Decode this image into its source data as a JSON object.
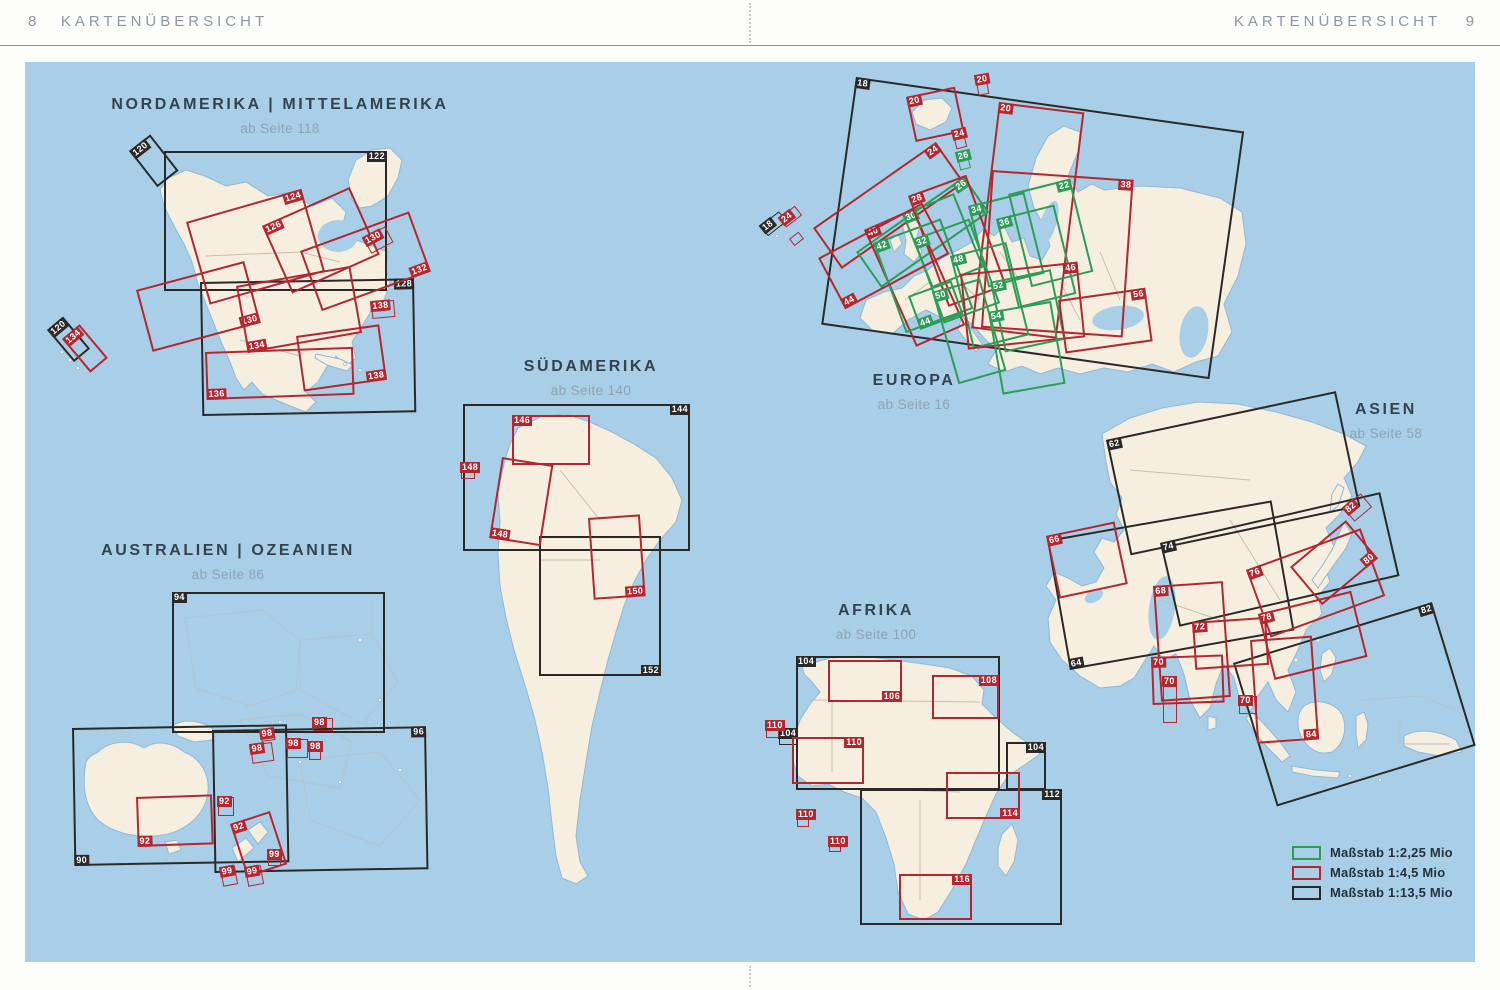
{
  "header": {
    "left_page": "8",
    "left_title": "KARTENÜBERSICHT",
    "right_title": "KARTENÜBERSICHT",
    "right_page": "9"
  },
  "colors": {
    "ocean": "#a9cfe8",
    "land": "#f6efdf",
    "scale_green": "#2d9c57",
    "scale_red": "#b5262f",
    "scale_black": "#2a2927"
  },
  "regions": [
    {
      "id": "nordamerika",
      "title": "NORDAMERIKA | MITTELAMERIKA",
      "subtitle": "ab Seite 118",
      "cx": 280,
      "y": 96
    },
    {
      "id": "suedamerika",
      "title": "SÜDAMERIKA",
      "subtitle": "ab Seite 140",
      "cx": 591,
      "y": 358
    },
    {
      "id": "australien",
      "title": "AUSTRALIEN | OZEANIEN",
      "subtitle": "ab Seite 86",
      "cx": 228,
      "y": 542
    },
    {
      "id": "europa",
      "title": "EUROPA",
      "subtitle": "ab Seite 16",
      "cx": 914,
      "y": 372
    },
    {
      "id": "asien",
      "title": "ASIEN",
      "subtitle": "ab Seite 58",
      "cx": 1386,
      "y": 401
    },
    {
      "id": "afrika",
      "title": "AFRIKA",
      "subtitle": "ab Seite 100",
      "cx": 876,
      "y": 602
    }
  ],
  "legend": {
    "items": [
      {
        "color": "green",
        "label": "Maßstab 1:2,25 Mio"
      },
      {
        "color": "red",
        "label": "Maßstab 1:4,5 Mio"
      },
      {
        "color": "black",
        "label": "Maßstab 1:13,5 Mio"
      }
    ]
  },
  "map_rects": [
    {
      "region": "nordamerika",
      "label": "122",
      "color": "black",
      "x": 164,
      "y": 151,
      "w": 223,
      "h": 140,
      "rot": 0,
      "corner": "tr"
    },
    {
      "region": "nordamerika",
      "label": "128",
      "color": "black",
      "x": 200,
      "y": 282,
      "w": 214,
      "h": 134,
      "rot": -1,
      "corner": "tr"
    },
    {
      "region": "nordamerika",
      "label": "120",
      "color": "black",
      "x": 129,
      "y": 151,
      "w": 27,
      "h": 46,
      "rot": -38,
      "corner": "tl"
    },
    {
      "region": "nordamerika",
      "label": "120",
      "color": "black",
      "x": 47,
      "y": 330,
      "w": 21,
      "h": 42,
      "rot": -40,
      "corner": "tl"
    },
    {
      "region": "nordamerika",
      "label": "134",
      "color": "red",
      "x": 62,
      "y": 339,
      "w": 23,
      "h": 44,
      "rot": -40,
      "corner": "tl"
    },
    {
      "region": "nordamerika",
      "label": "124",
      "color": "red",
      "x": 186,
      "y": 222,
      "w": 120,
      "h": 86,
      "rot": -16,
      "corner": "tr"
    },
    {
      "region": "nordamerika",
      "label": "126",
      "color": "red",
      "x": 262,
      "y": 226,
      "w": 96,
      "h": 74,
      "rot": -24,
      "corner": "tl"
    },
    {
      "region": "nordamerika",
      "label": "130",
      "color": "red",
      "x": 363,
      "y": 238,
      "w": 25,
      "h": 18,
      "rot": -28,
      "corner": "tl"
    },
    {
      "region": "nordamerika",
      "label": "130",
      "color": "red",
      "x": 136,
      "y": 290,
      "w": 112,
      "h": 64,
      "rot": -15,
      "corner": "br"
    },
    {
      "region": "nordamerika",
      "label": "132",
      "color": "red",
      "x": 300,
      "y": 251,
      "w": 116,
      "h": 64,
      "rot": -20,
      "corner": "br"
    },
    {
      "region": "nordamerika",
      "label": "134",
      "color": "red",
      "x": 236,
      "y": 286,
      "w": 116,
      "h": 68,
      "rot": -10,
      "corner": "bl"
    },
    {
      "region": "nordamerika",
      "label": "136",
      "color": "red",
      "x": 205,
      "y": 352,
      "w": 148,
      "h": 48,
      "rot": -2,
      "corner": "bl"
    },
    {
      "region": "nordamerika",
      "label": "138",
      "color": "red",
      "x": 371,
      "y": 302,
      "w": 23,
      "h": 17,
      "rot": -5,
      "corner": "tl"
    },
    {
      "region": "nordamerika",
      "label": "138",
      "color": "red",
      "x": 296,
      "y": 336,
      "w": 84,
      "h": 56,
      "rot": -8,
      "corner": "br"
    },
    {
      "region": "suedamerika",
      "label": "144",
      "color": "black",
      "x": 463,
      "y": 404,
      "w": 227,
      "h": 147,
      "rot": 0,
      "corner": "tr"
    },
    {
      "region": "suedamerika",
      "label": "152",
      "color": "black",
      "x": 539,
      "y": 536,
      "w": 122,
      "h": 140,
      "rot": 0,
      "corner": "br"
    },
    {
      "region": "suedamerika",
      "label": "146",
      "color": "red",
      "x": 512,
      "y": 415,
      "w": 78,
      "h": 50,
      "rot": 0,
      "corner": "tl"
    },
    {
      "region": "suedamerika",
      "label": "148",
      "color": "red",
      "x": 461,
      "y": 463,
      "w": 14,
      "h": 16,
      "rot": 0,
      "corner": "tl"
    },
    {
      "region": "suedamerika",
      "label": "148",
      "color": "red",
      "x": 502,
      "y": 457,
      "w": 52,
      "h": 82,
      "rot": 9,
      "corner": "bl"
    },
    {
      "region": "suedamerika",
      "label": "150",
      "color": "red",
      "x": 588,
      "y": 518,
      "w": 52,
      "h": 82,
      "rot": -4,
      "corner": "br"
    },
    {
      "region": "australien",
      "label": "94",
      "color": "black",
      "x": 172,
      "y": 592,
      "w": 213,
      "h": 141,
      "rot": 0,
      "corner": "tl"
    },
    {
      "region": "australien",
      "label": "90",
      "color": "black",
      "x": 72,
      "y": 728,
      "w": 215,
      "h": 138,
      "rot": -1,
      "corner": "bl"
    },
    {
      "region": "australien",
      "label": "96",
      "color": "black",
      "x": 212,
      "y": 730,
      "w": 214,
      "h": 143,
      "rot": -1,
      "corner": "tr"
    },
    {
      "region": "australien",
      "label": "92",
      "color": "red",
      "x": 136,
      "y": 797,
      "w": 76,
      "h": 50,
      "rot": -2,
      "corner": "bl"
    },
    {
      "region": "australien",
      "label": "92",
      "color": "red",
      "x": 218,
      "y": 797,
      "w": 16,
      "h": 19,
      "rot": 0,
      "corner": "tl"
    },
    {
      "region": "australien",
      "label": "92",
      "color": "red",
      "x": 230,
      "y": 824,
      "w": 42,
      "h": 56,
      "rot": -18,
      "corner": "tl"
    },
    {
      "region": "australien",
      "label": "98",
      "color": "red",
      "x": 250,
      "y": 745,
      "w": 22,
      "h": 19,
      "rot": -8,
      "corner": "tl"
    },
    {
      "region": "australien",
      "label": "98",
      "color": "red",
      "x": 260,
      "y": 730,
      "w": 14,
      "h": 12,
      "rot": -8,
      "corner": "tl"
    },
    {
      "region": "australien",
      "label": "98",
      "color": "red",
      "x": 287,
      "y": 739,
      "w": 21,
      "h": 19,
      "rot": 0,
      "corner": "tl"
    },
    {
      "region": "australien",
      "label": "98",
      "color": "red",
      "x": 309,
      "y": 742,
      "w": 12,
      "h": 18,
      "rot": 0,
      "corner": "tl"
    },
    {
      "region": "australien",
      "label": "98",
      "color": "red",
      "x": 313,
      "y": 718,
      "w": 20,
      "h": 13,
      "rot": 0,
      "corner": "tl"
    },
    {
      "region": "australien",
      "label": "99",
      "color": "red",
      "x": 220,
      "y": 868,
      "w": 15,
      "h": 19,
      "rot": -10,
      "corner": "tl"
    },
    {
      "region": "australien",
      "label": "99",
      "color": "red",
      "x": 245,
      "y": 868,
      "w": 16,
      "h": 19,
      "rot": -10,
      "corner": "tl"
    },
    {
      "region": "australien",
      "label": "99",
      "color": "red",
      "x": 268,
      "y": 850,
      "w": 13,
      "h": 16,
      "rot": 0,
      "corner": "tl"
    },
    {
      "region": "europa",
      "label": "18",
      "color": "black",
      "x": 856,
      "y": 77,
      "w": 392,
      "h": 250,
      "rot": 8,
      "corner": "tl"
    },
    {
      "region": "europa",
      "label": "18",
      "color": "black",
      "x": 760,
      "y": 226,
      "w": 24,
      "h": 13,
      "rot": -38,
      "corner": "tl"
    },
    {
      "region": "europa",
      "label": "24",
      "color": "red",
      "x": 779,
      "y": 218,
      "w": 20,
      "h": 12,
      "rot": -38,
      "corner": "tl"
    },
    {
      "region": "europa",
      "label": "",
      "color": "red",
      "x": 789,
      "y": 239,
      "w": 12,
      "h": 9,
      "rot": -38,
      "corner": "tl"
    },
    {
      "region": "europa",
      "label": "20",
      "color": "red",
      "x": 906,
      "y": 97,
      "w": 50,
      "h": 46,
      "rot": -12,
      "corner": "tl"
    },
    {
      "region": "europa",
      "label": "20",
      "color": "red",
      "x": 975,
      "y": 76,
      "w": 11,
      "h": 20,
      "rot": -10,
      "corner": "tl"
    },
    {
      "region": "europa",
      "label": "20",
      "color": "red",
      "x": 999,
      "y": 102,
      "w": 86,
      "h": 228,
      "rot": 7,
      "corner": "tl"
    },
    {
      "region": "europa",
      "label": "24",
      "color": "red",
      "x": 952,
      "y": 131,
      "w": 11,
      "h": 19,
      "rot": -14,
      "corner": "tl"
    },
    {
      "region": "europa",
      "label": "24",
      "color": "red",
      "x": 813,
      "y": 228,
      "w": 150,
      "h": 50,
      "rot": -35,
      "corner": "tr"
    },
    {
      "region": "europa",
      "label": "26",
      "color": "green",
      "x": 956,
      "y": 153,
      "w": 11,
      "h": 18,
      "rot": -14,
      "corner": "tl"
    },
    {
      "region": "europa",
      "label": "26",
      "color": "green",
      "x": 856,
      "y": 252,
      "w": 132,
      "h": 44,
      "rot": -35,
      "corner": "tr"
    },
    {
      "region": "europa",
      "label": "28",
      "color": "red",
      "x": 908,
      "y": 196,
      "w": 62,
      "h": 118,
      "rot": -20,
      "corner": "tl"
    },
    {
      "region": "europa",
      "label": "30",
      "color": "green",
      "x": 902,
      "y": 214,
      "w": 56,
      "h": 80,
      "rot": -22,
      "corner": "tl"
    },
    {
      "region": "europa",
      "label": "22",
      "color": "green",
      "x": 1008,
      "y": 194,
      "w": 64,
      "h": 96,
      "rot": -14,
      "corner": "tr"
    },
    {
      "region": "europa",
      "label": "34",
      "color": "green",
      "x": 968,
      "y": 206,
      "w": 58,
      "h": 84,
      "rot": -14,
      "corner": "tl"
    },
    {
      "region": "europa",
      "label": "36",
      "color": "green",
      "x": 996,
      "y": 219,
      "w": 60,
      "h": 92,
      "rot": -14,
      "corner": "tl"
    },
    {
      "region": "europa",
      "label": "38",
      "color": "red",
      "x": 992,
      "y": 170,
      "w": 142,
      "h": 158,
      "rot": 4,
      "corner": "tr"
    },
    {
      "region": "europa",
      "label": "40",
      "color": "red",
      "x": 864,
      "y": 230,
      "w": 54,
      "h": 128,
      "rot": -24,
      "corner": "tl"
    },
    {
      "region": "europa",
      "label": "42",
      "color": "green",
      "x": 873,
      "y": 243,
      "w": 72,
      "h": 96,
      "rot": -20,
      "corner": "tl"
    },
    {
      "region": "europa",
      "label": "32",
      "color": "green",
      "x": 913,
      "y": 239,
      "w": 60,
      "h": 90,
      "rot": -20,
      "corner": "tl"
    },
    {
      "region": "europa",
      "label": "48",
      "color": "green",
      "x": 950,
      "y": 256,
      "w": 58,
      "h": 96,
      "rot": -14,
      "corner": "tl"
    },
    {
      "region": "europa",
      "label": "44",
      "color": "red",
      "x": 818,
      "y": 258,
      "w": 118,
      "h": 58,
      "rot": -28,
      "corner": "bl"
    },
    {
      "region": "europa",
      "label": "44",
      "color": "green",
      "x": 908,
      "y": 296,
      "w": 46,
      "h": 36,
      "rot": -20,
      "corner": "bl"
    },
    {
      "region": "europa",
      "label": "50",
      "color": "green",
      "x": 932,
      "y": 292,
      "w": 50,
      "h": 96,
      "rot": -16,
      "corner": "tl"
    },
    {
      "region": "europa",
      "label": "46",
      "color": "red",
      "x": 960,
      "y": 274,
      "w": 118,
      "h": 76,
      "rot": -6,
      "corner": "tr"
    },
    {
      "region": "europa",
      "label": "52",
      "color": "green",
      "x": 990,
      "y": 282,
      "w": 62,
      "h": 72,
      "rot": -12,
      "corner": "tl"
    },
    {
      "region": "europa",
      "label": "54",
      "color": "green",
      "x": 988,
      "y": 312,
      "w": 64,
      "h": 84,
      "rot": -10,
      "corner": "tl"
    },
    {
      "region": "europa",
      "label": "56",
      "color": "red",
      "x": 1058,
      "y": 300,
      "w": 88,
      "h": 54,
      "rot": -8,
      "corner": "tr"
    },
    {
      "region": "asien",
      "label": "62",
      "color": "black",
      "x": 1106,
      "y": 440,
      "w": 235,
      "h": 118,
      "rot": -12,
      "corner": "tl"
    },
    {
      "region": "asien",
      "label": "74",
      "color": "black",
      "x": 1160,
      "y": 543,
      "w": 226,
      "h": 86,
      "rot": -13,
      "corner": "tl"
    },
    {
      "region": "asien",
      "label": "64",
      "color": "black",
      "x": 1047,
      "y": 540,
      "w": 228,
      "h": 132,
      "rot": -10,
      "corner": "bl"
    },
    {
      "region": "asien",
      "label": "82",
      "color": "black",
      "x": 1233,
      "y": 663,
      "w": 208,
      "h": 150,
      "rot": -17,
      "corner": "tr"
    },
    {
      "region": "asien",
      "label": "66",
      "color": "red",
      "x": 1046,
      "y": 536,
      "w": 70,
      "h": 64,
      "rot": -12,
      "corner": "tl"
    },
    {
      "region": "asien",
      "label": "68",
      "color": "red",
      "x": 1153,
      "y": 586,
      "w": 70,
      "h": 116,
      "rot": -4,
      "corner": "tl"
    },
    {
      "region": "asien",
      "label": "72",
      "color": "red",
      "x": 1192,
      "y": 622,
      "w": 74,
      "h": 48,
      "rot": -4,
      "corner": "tl"
    },
    {
      "region": "asien",
      "label": "76",
      "color": "red",
      "x": 1246,
      "y": 570,
      "w": 122,
      "h": 72,
      "rot": -20,
      "corner": "tl"
    },
    {
      "region": "asien",
      "label": "78",
      "color": "red",
      "x": 1258,
      "y": 614,
      "w": 96,
      "h": 68,
      "rot": -14,
      "corner": "tl"
    },
    {
      "region": "asien",
      "label": "80",
      "color": "red",
      "x": 1290,
      "y": 567,
      "w": 73,
      "h": 50,
      "rot": -40,
      "corner": "br"
    },
    {
      "region": "asien",
      "label": "82",
      "color": "red",
      "x": 1343,
      "y": 508,
      "w": 23,
      "h": 18,
      "rot": -40,
      "corner": "tl"
    },
    {
      "region": "asien",
      "label": "70",
      "color": "red",
      "x": 1151,
      "y": 657,
      "w": 72,
      "h": 48,
      "rot": -2,
      "corner": "tl"
    },
    {
      "region": "asien",
      "label": "70",
      "color": "red",
      "x": 1163,
      "y": 677,
      "w": 14,
      "h": 46,
      "rot": 0,
      "corner": "tl"
    },
    {
      "region": "asien",
      "label": "70",
      "color": "red",
      "x": 1239,
      "y": 696,
      "w": 18,
      "h": 18,
      "rot": 0,
      "corner": "tl"
    },
    {
      "region": "asien",
      "label": "84",
      "color": "red",
      "x": 1250,
      "y": 640,
      "w": 62,
      "h": 104,
      "rot": -4,
      "corner": "br"
    },
    {
      "region": "afrika",
      "label": "104",
      "color": "black",
      "x": 796,
      "y": 656,
      "w": 204,
      "h": 134,
      "rot": 0,
      "corner": "tl"
    },
    {
      "region": "afrika",
      "label": "104",
      "color": "black",
      "x": 779,
      "y": 729,
      "w": 19,
      "h": 16,
      "rot": 0,
      "corner": "tl"
    },
    {
      "region": "afrika",
      "label": "104",
      "color": "black",
      "x": 1006,
      "y": 742,
      "w": 40,
      "h": 48,
      "rot": 0,
      "corner": "tr"
    },
    {
      "region": "afrika",
      "label": "112",
      "color": "black",
      "x": 860,
      "y": 789,
      "w": 202,
      "h": 136,
      "rot": 0,
      "corner": "tr"
    },
    {
      "region": "afrika",
      "label": "106",
      "color": "red",
      "x": 828,
      "y": 660,
      "w": 74,
      "h": 42,
      "rot": 0,
      "corner": "br"
    },
    {
      "region": "afrika",
      "label": "108",
      "color": "red",
      "x": 932,
      "y": 675,
      "w": 67,
      "h": 44,
      "rot": 0,
      "corner": "tr"
    },
    {
      "region": "afrika",
      "label": "110",
      "color": "red",
      "x": 766,
      "y": 721,
      "w": 13,
      "h": 17,
      "rot": 0,
      "corner": "tl"
    },
    {
      "region": "afrika",
      "label": "110",
      "color": "red",
      "x": 792,
      "y": 737,
      "w": 72,
      "h": 47,
      "rot": 0,
      "corner": "tr"
    },
    {
      "region": "afrika",
      "label": "110",
      "color": "red",
      "x": 797,
      "y": 810,
      "w": 12,
      "h": 17,
      "rot": 0,
      "corner": "tl"
    },
    {
      "region": "afrika",
      "label": "110",
      "color": "red",
      "x": 829,
      "y": 837,
      "w": 12,
      "h": 15,
      "rot": 0,
      "corner": "tl"
    },
    {
      "region": "afrika",
      "label": "114",
      "color": "red",
      "x": 946,
      "y": 772,
      "w": 74,
      "h": 47,
      "rot": 0,
      "corner": "br"
    },
    {
      "region": "afrika",
      "label": "116",
      "color": "red",
      "x": 899,
      "y": 874,
      "w": 73,
      "h": 46,
      "rot": 0,
      "corner": "tr"
    }
  ]
}
